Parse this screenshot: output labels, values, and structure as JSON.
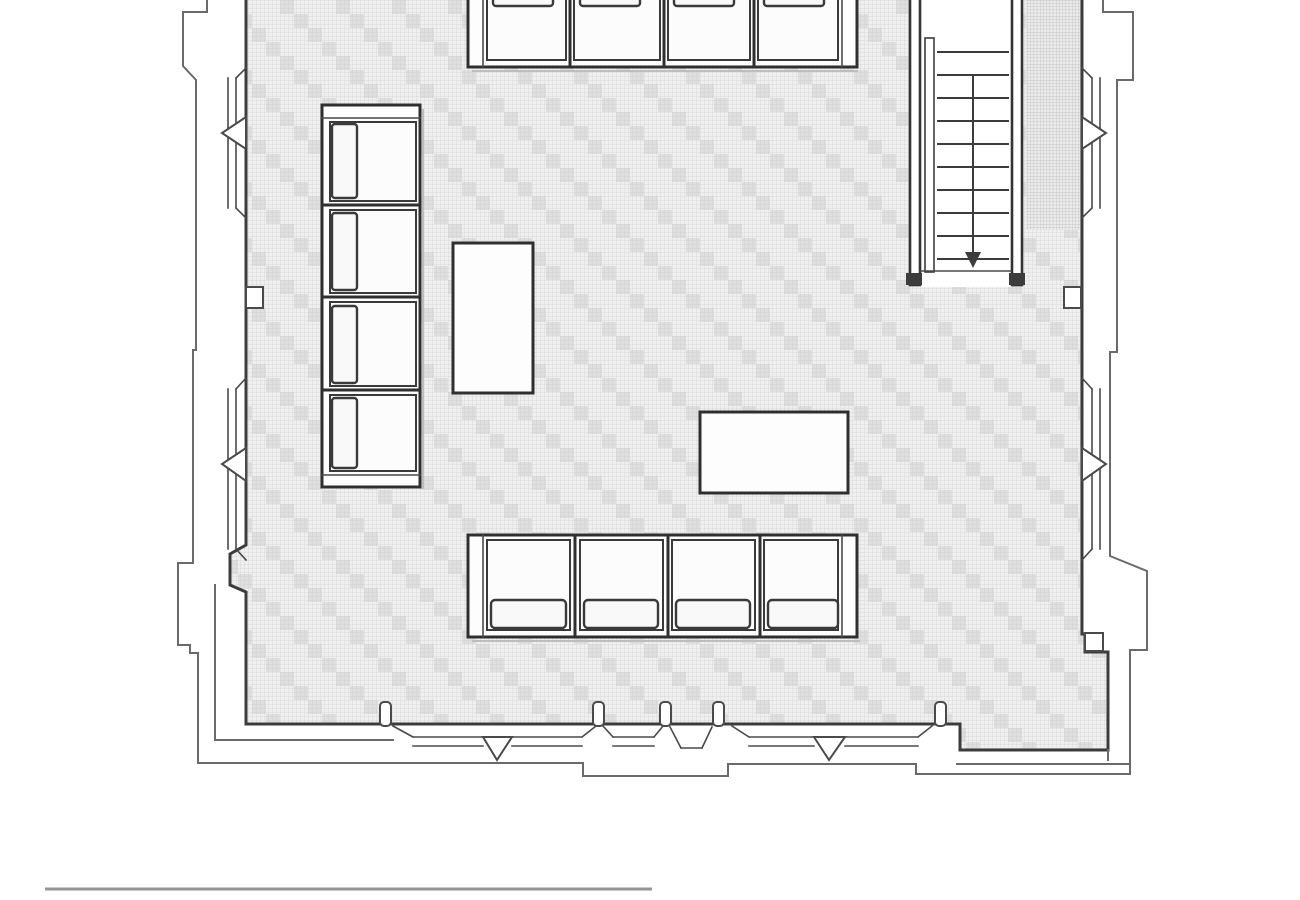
{
  "meta": {
    "title": "Architectural floor plan, cropped view of a furnished hall",
    "drawing_type": "floor-plan line drawing",
    "background": "#ffffff"
  },
  "colors": {
    "line_dark": "#3c3c3c",
    "line_medium": "#6a6a6a",
    "furniture_stroke": "#2f2f2f",
    "furniture_fill": "#fdfdfd",
    "carpet_base": "#f1f0f0",
    "carpet_grid": "#d7d7d7",
    "carpet_motif": "#c7c7c7",
    "wall_hatch": "#c2c2c2",
    "scale_bar": "#949494"
  },
  "floor": {
    "finish": "carpet with fine square grid and interlocking stepped zigzag motif",
    "extent": "fills the hall interior, cropped at top edge"
  },
  "staircase": {
    "location": "top-right",
    "treads": 10,
    "walk_line_arrow": "down",
    "handrail": "left side inner rail"
  },
  "furniture": {
    "top_bench": {
      "seats": 4,
      "orientation": "horizontal, cropped at top edge"
    },
    "bottom_bench": {
      "seats": 4,
      "cushions": 4,
      "orientation": "horizontal"
    },
    "left_sofa": {
      "seats": 4,
      "cushions": 4,
      "orientation": "vertical"
    },
    "side_table": {
      "shape": "vertical rectangle"
    },
    "center_table": {
      "shape": "horizontal rectangle"
    }
  },
  "walls": {
    "left_windows": 2,
    "right_windows": 2,
    "bottom_windows": 2,
    "window_style": "splayed reveals with pointed triangular center",
    "bottom_mullion_posts": 5,
    "corner_buttresses": 2,
    "pilaster_notches": 2
  },
  "scale_bar": {
    "present": true,
    "style": "plain horizontal line, bottom-left"
  }
}
